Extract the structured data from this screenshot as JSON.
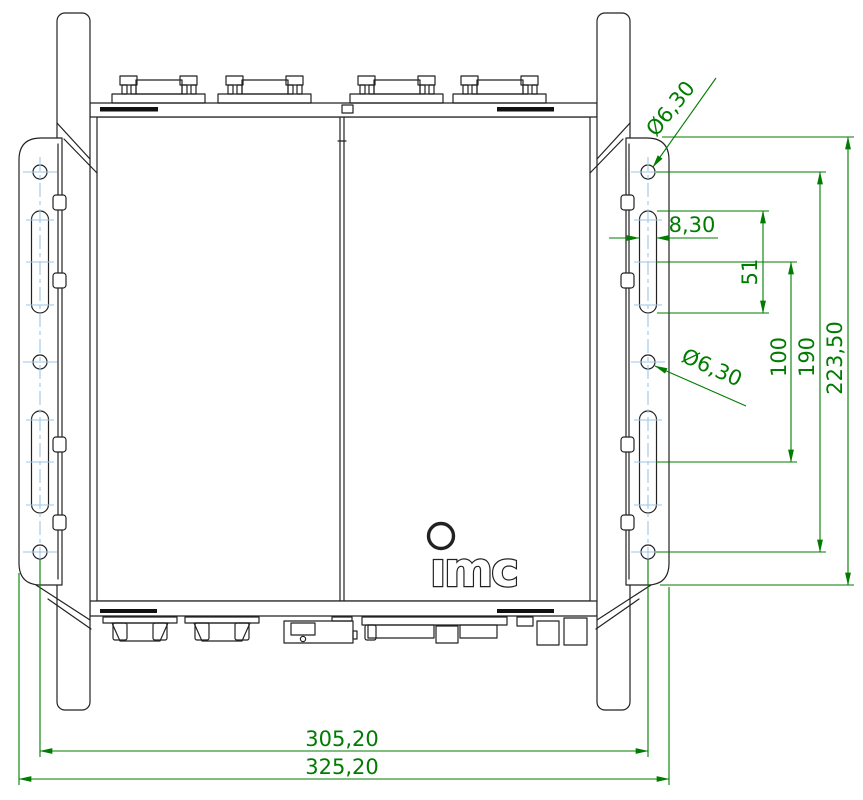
{
  "drawing": {
    "kind": "technical-dimension-drawing",
    "logo": {
      "text": "ımc"
    },
    "colors": {
      "outline": "#222222",
      "dimension_green": "#007c00",
      "centerline_blue": "#9cc5e8",
      "vent_fill": "#111111"
    },
    "dimensions": {
      "top_hole_diameter": "Ø6,30",
      "middle_hole_diameter": "Ø6,30",
      "slot_width": "8,30",
      "slot_length": "51",
      "slot_center_distance": "100",
      "outer_hole_distance": "190",
      "bracket_height": "223,50",
      "mounting_hole_span": "305,20",
      "overall_width": "325,20"
    }
  }
}
